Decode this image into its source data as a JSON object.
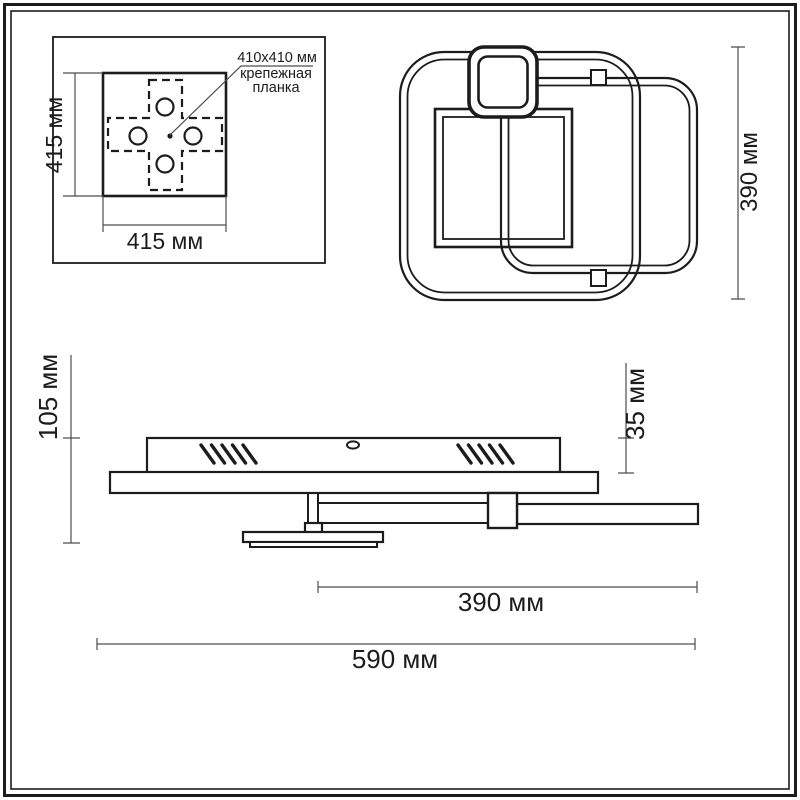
{
  "drawing": {
    "mount_panel": {
      "callout": {
        "line1": "410x410 мм",
        "line2": "крепежная",
        "line3": "планка"
      },
      "dim_side": "415 мм",
      "dim_bottom": "415 мм"
    },
    "top_view": {
      "dim_height": "390 мм"
    },
    "side_view": {
      "dim_height_total": "105 мм",
      "dim_height_canopy": "35 мм",
      "dim_width_inner": "390 мм",
      "dim_width_total": "590 мм"
    },
    "colors": {
      "line": "#1c1c1c",
      "dim_line": "#4d4d4d",
      "background": "#ffffff"
    }
  }
}
